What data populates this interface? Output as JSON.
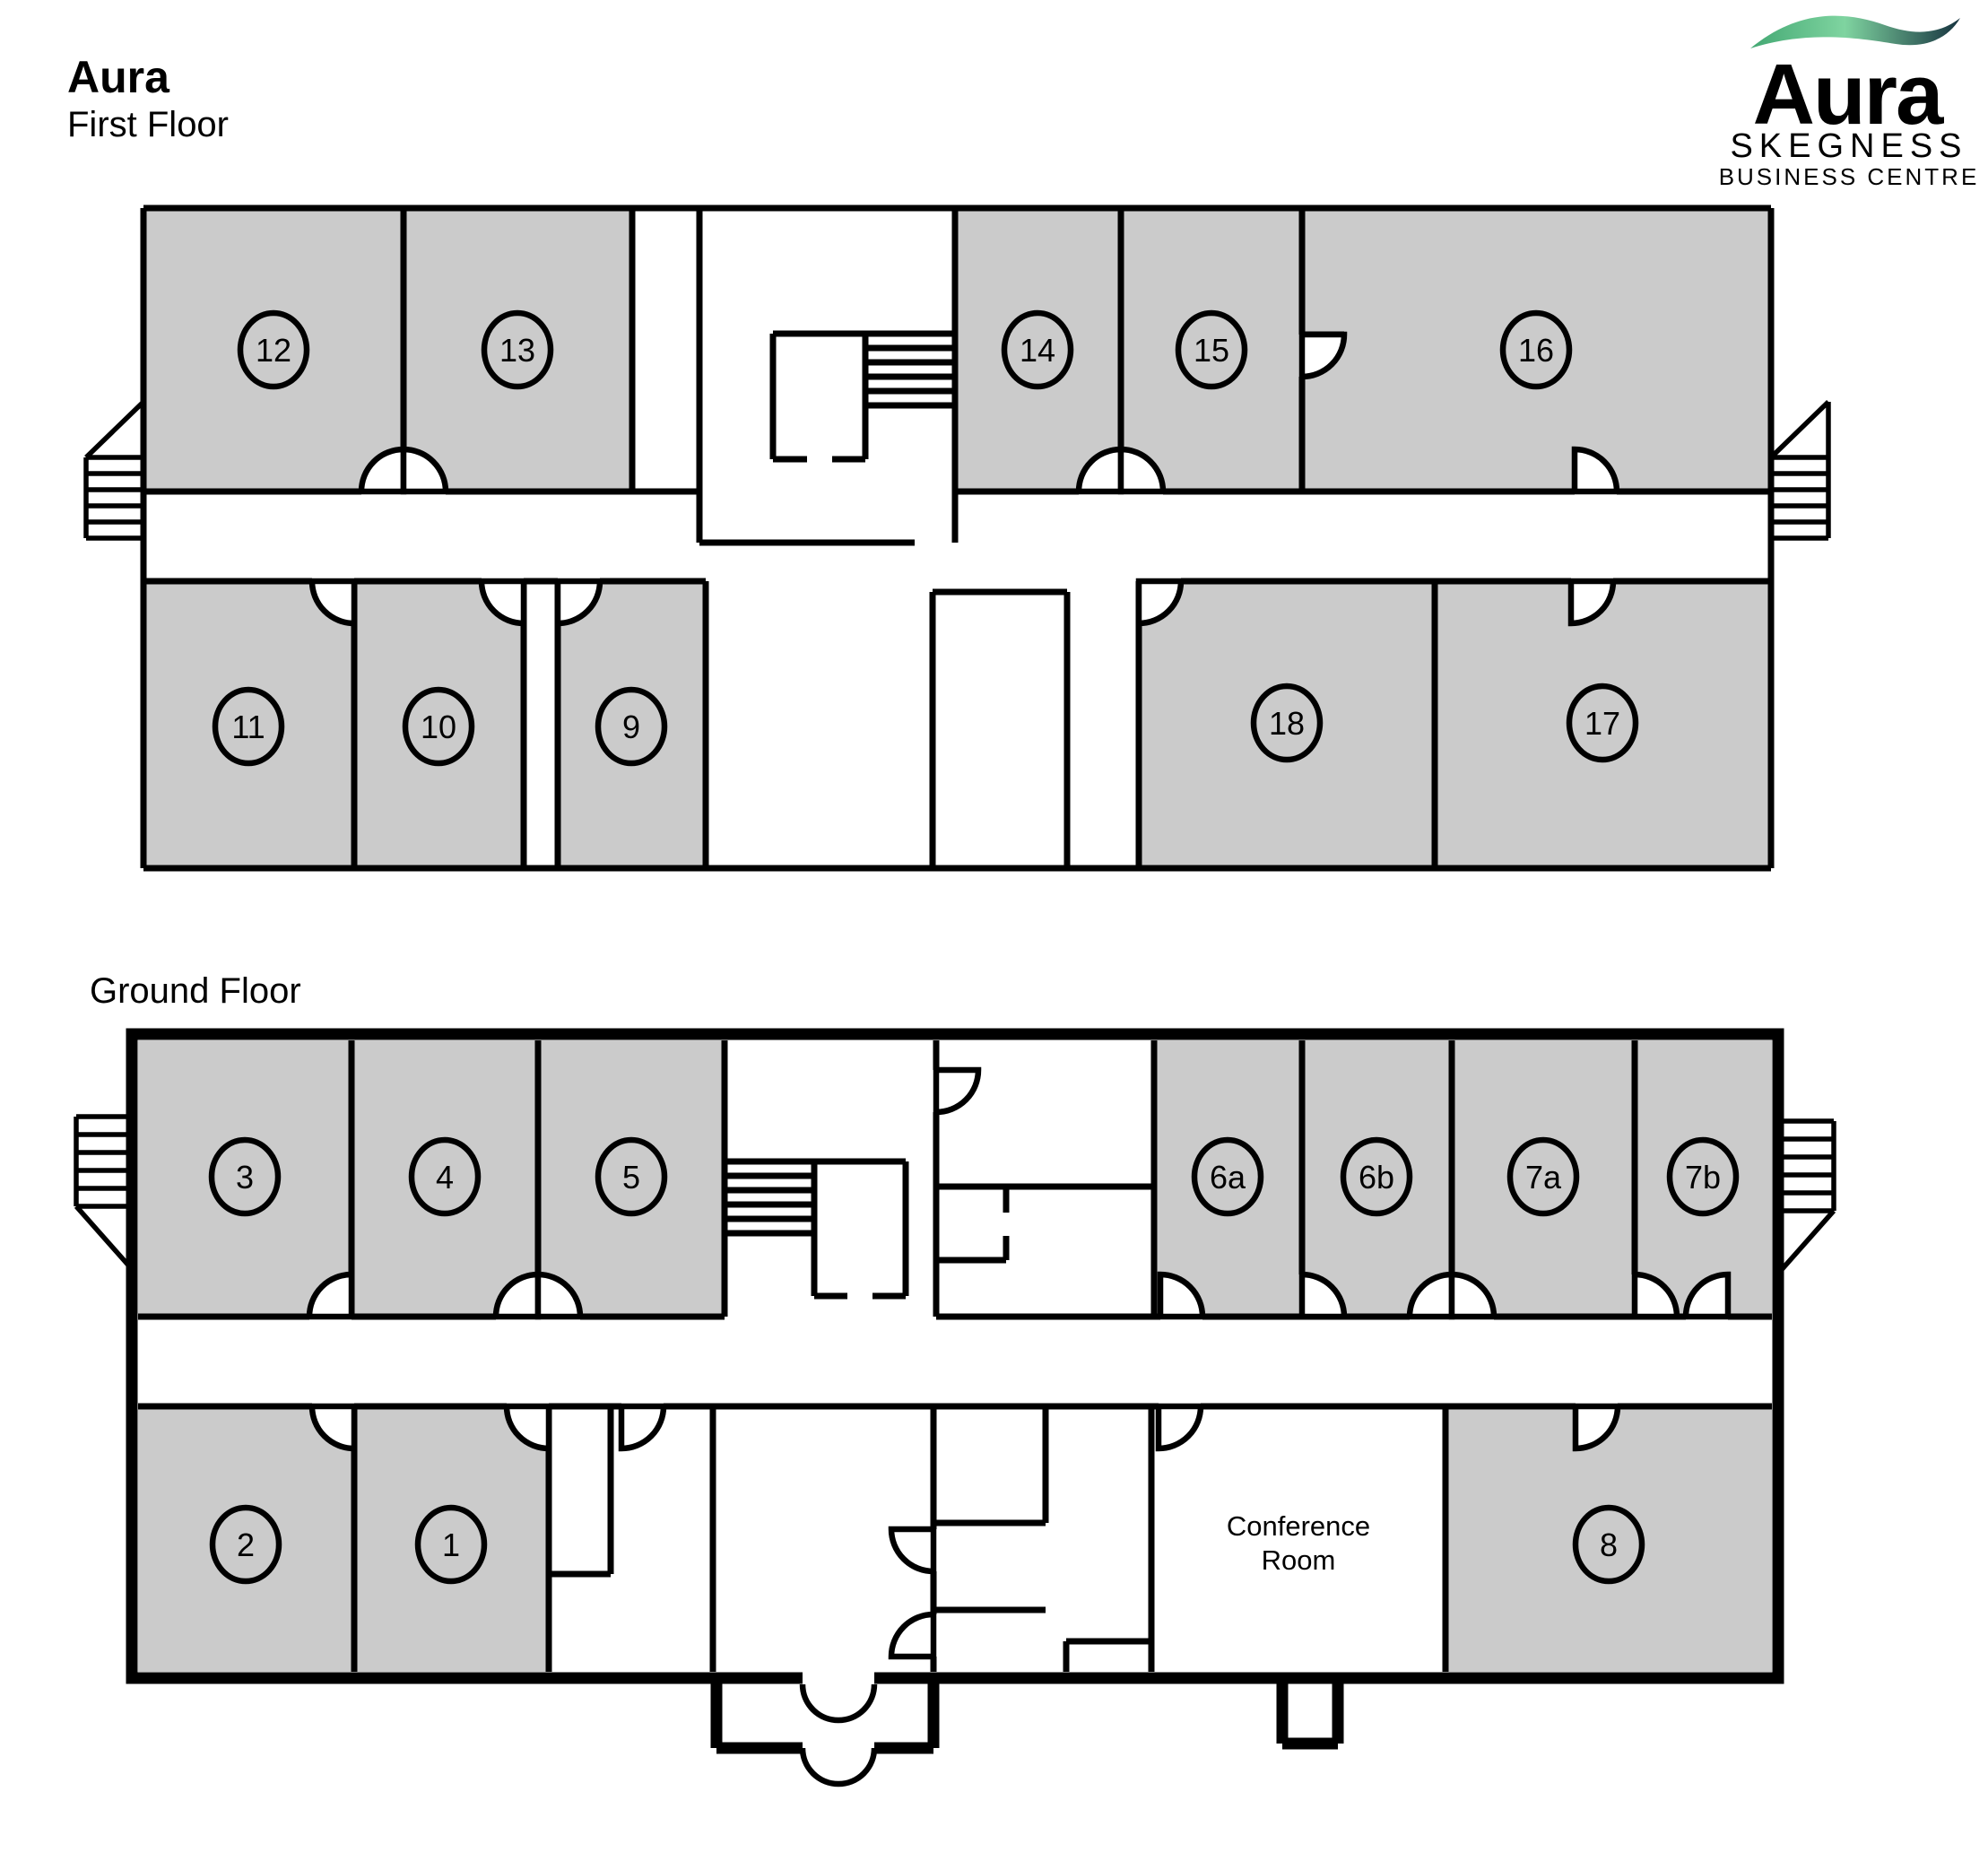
{
  "header": {
    "title": "Aura",
    "subtitle": "First Floor"
  },
  "ground_floor": {
    "label": "Ground Floor"
  },
  "logo": {
    "brand": "Aura",
    "line1": "SKEGNESS",
    "line2": "BUSINESS CENTRE",
    "brand_color": "#1d3b49",
    "accent_color": "#8be7ab",
    "swoosh_start": "#43a873",
    "swoosh_mid": "#7fd4a0",
    "swoosh_end": "#16333f"
  },
  "colors": {
    "room_fill": "#cbcbcb",
    "wall": "#000000",
    "background": "#ffffff"
  },
  "floors": {
    "first": {
      "rooms": [
        {
          "label": "12"
        },
        {
          "label": "13"
        },
        {
          "label": "14"
        },
        {
          "label": "15"
        },
        {
          "label": "16"
        },
        {
          "label": "11"
        },
        {
          "label": "10"
        },
        {
          "label": "9"
        },
        {
          "label": "18"
        },
        {
          "label": "17"
        }
      ]
    },
    "ground": {
      "rooms": [
        {
          "label": "3"
        },
        {
          "label": "4"
        },
        {
          "label": "5"
        },
        {
          "label": "6a"
        },
        {
          "label": "6b"
        },
        {
          "label": "7a"
        },
        {
          "label": "7b"
        },
        {
          "label": "2"
        },
        {
          "label": "1"
        },
        {
          "label": "8"
        }
      ],
      "conference_room": {
        "line1": "Conference",
        "line2": "Room"
      }
    }
  }
}
